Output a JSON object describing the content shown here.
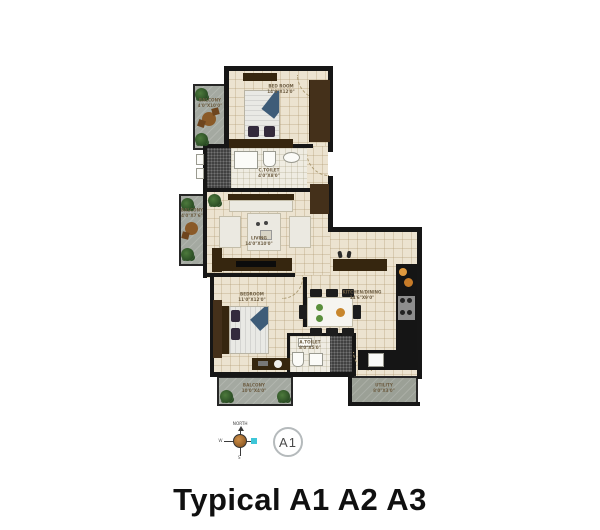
{
  "title": "Typical A1 A2 A3",
  "unit_badge": "A1",
  "compass": {
    "north": "NORTH",
    "west": "W",
    "south": "S"
  },
  "colors": {
    "wall": "#161616",
    "floor": "#ece3d0",
    "balcony": "#a4a9a1",
    "wood": "#44301a",
    "accent_blue": "#3e5c78",
    "compass_orange": "#b06a2a",
    "compass_cyan": "#3ec6d8",
    "title_color": "#101010"
  },
  "rooms": {
    "bedroom1": {
      "label": "BED ROOM",
      "dims": "14'0\"X12'0\""
    },
    "balcony1": {
      "label": "BALCONY",
      "dims": "4'0\"X10'0\""
    },
    "ctoilet": {
      "label": "C.TOILET",
      "dims": "4'0\"X8'0\""
    },
    "living": {
      "label": "LIVING",
      "dims": "14'0\"X10'0\""
    },
    "balcony2": {
      "label": "BALCONY",
      "dims": "4'0\"X7'6\""
    },
    "bedroom2": {
      "label": "BEDROOM",
      "dims": "11'0\"X12'0\""
    },
    "kitchen": {
      "label": "KITCHEN/DINING",
      "dims": "14'6\"X9'0\""
    },
    "atoilet": {
      "label": "A.TOILET",
      "dims": "8'0\"X5'0\""
    },
    "utility": {
      "label": "UTILITY",
      "dims": "8'0\"X3'0\""
    },
    "balcony3": {
      "label": "BALCONY",
      "dims": "10'0\"X4'0\""
    }
  }
}
